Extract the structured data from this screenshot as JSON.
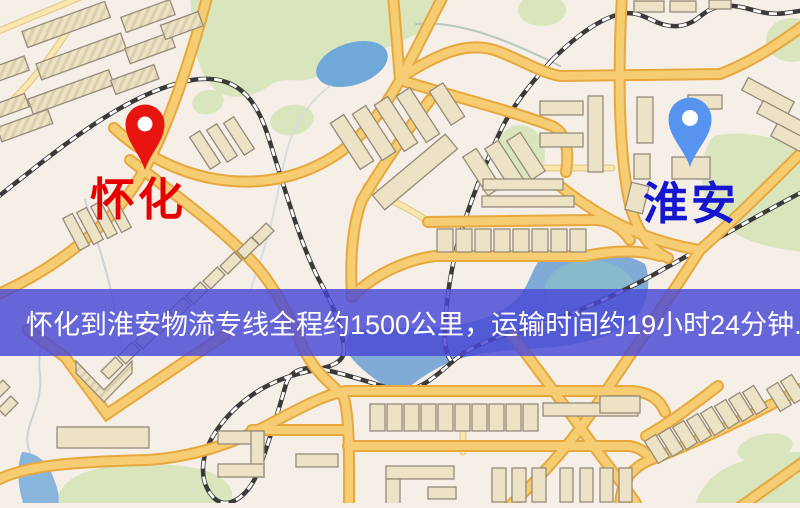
{
  "banner": {
    "text": "怀化到淮安物流专线全程约1500公里，运输时间约19小时24分钟.",
    "bg_color": "rgba(72,72,214,0.82)",
    "text_color": "#ffffff"
  },
  "markers": {
    "origin": {
      "name": "怀化",
      "pin_color": "#e81410",
      "label_color": "#e60000"
    },
    "destination": {
      "name": "淮安",
      "pin_color": "#5694ef",
      "label_color": "#1616cf"
    }
  },
  "map_palette": {
    "background": "#f5efe7",
    "road_major_fill": "#f6cd72",
    "road_major_casing": "#e7a83d",
    "road_minor_fill": "#fbe7ae",
    "road_minor_casing": "#e2cb93",
    "water": "#6ea9da",
    "pond_teal": "#8fc4c4",
    "park": "#d8e5bd",
    "building_fill": "#ece2c6",
    "building_stroke": "#968b79",
    "railway": "#3a3a3a"
  }
}
